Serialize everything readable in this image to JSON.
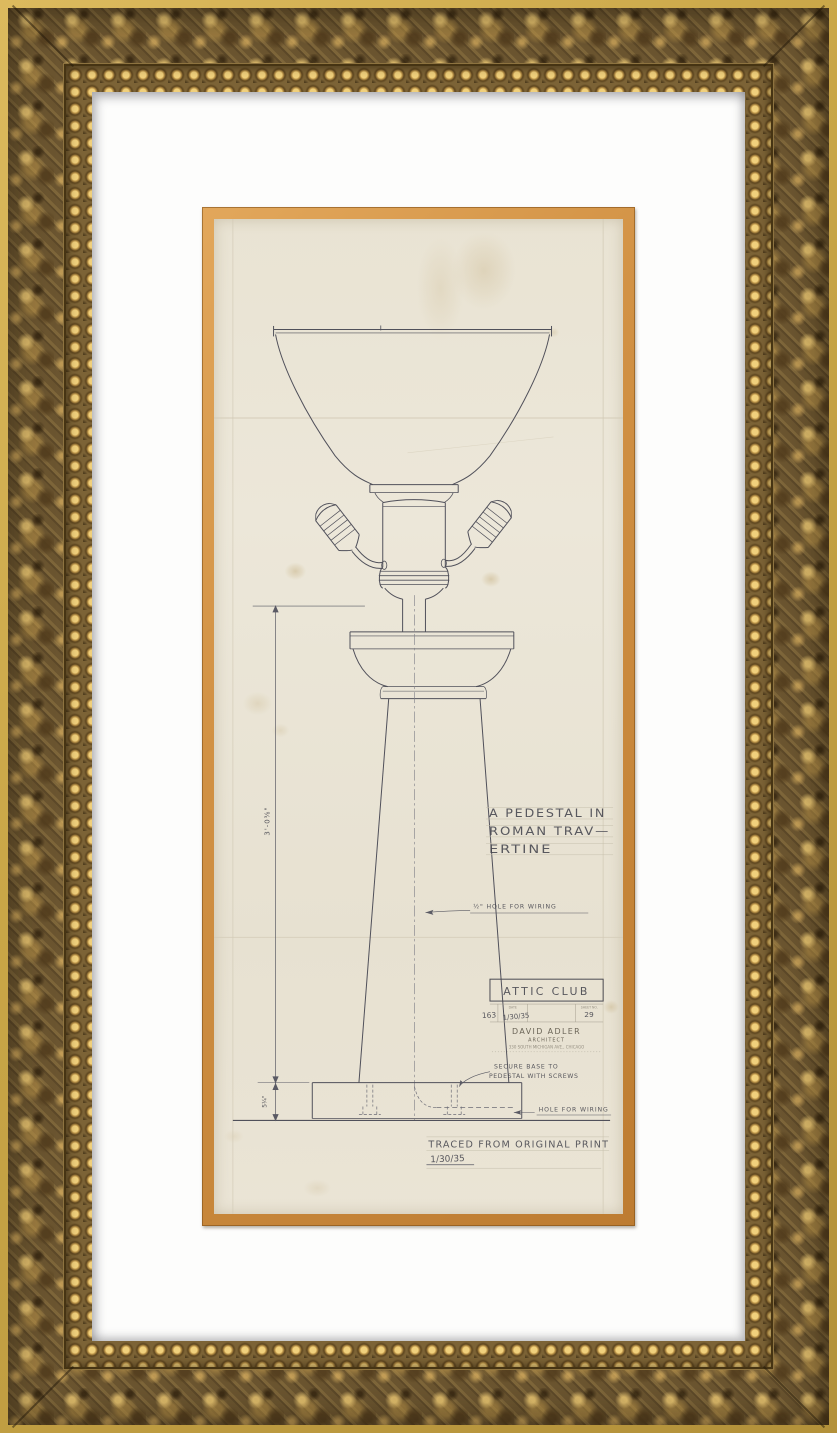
{
  "frame": {
    "style": "ornate gold baroque picture frame with white mat and gold fillet",
    "colors": {
      "outer_strip": "#c9a647",
      "carved_base": "#6b5530",
      "carved_highlight": "#ecc873",
      "bead": "#f0d07c",
      "mat": "#fdfdfc",
      "fillet": "#d29245",
      "paper": "#ebe5d6",
      "pencil": "#4e4e58"
    }
  },
  "drawing": {
    "subject": "elevation of a torchère lamp on a tapered pedestal column",
    "title_note": {
      "line1": "A PEDESTAL IN",
      "line2": "ROMAN TRAV—",
      "line3": "ERTINE"
    },
    "notes": {
      "wiring_hole": "½\" HOLE FOR WIRING",
      "secure_line1": "SECURE BASE TO",
      "secure_line2": "PEDESTAL WITH SCREWS",
      "base_wiring": "HOLE FOR WIRING",
      "traced": "TRACED FROM ORIGINAL PRINT",
      "traced_date": "1/30/35"
    },
    "dimensions": {
      "shaft_height": "3'-0⅜\"",
      "base_height": "5¼\""
    },
    "title_block": {
      "client": "ATTIC CLUB",
      "job_no": "163",
      "date": "1/30/35",
      "sheet_no": "29",
      "header_date": "DATE",
      "header_sheet": "SHEET NO.",
      "architect": "DAVID ADLER",
      "architect_title": "ARCHITECT",
      "address": "330 SOUTH MICHIGAN AVE., CHICAGO"
    }
  }
}
